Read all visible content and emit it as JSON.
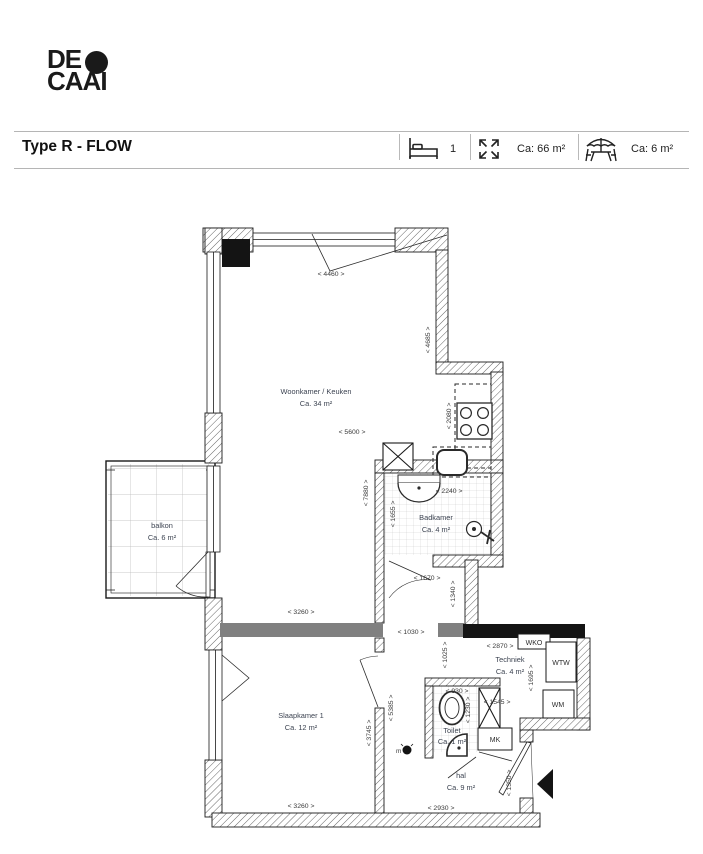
{
  "logo": {
    "line1": "DE",
    "line2": "CAAI"
  },
  "header": {
    "title": "Type R - FLOW",
    "bedroom_count": "1",
    "living_area": "Ca: 66 m²",
    "outdoor_area": "Ca: 6 m²"
  },
  "rooms": {
    "woonkamer": {
      "name": "Woonkamer / Keuken",
      "area": "Ca. 34 m²"
    },
    "balkon": {
      "name": "balkon",
      "area": "Ca. 6 m²"
    },
    "badkamer": {
      "name": "Badkamer",
      "area": "Ca. 4 m²"
    },
    "slaapkamer": {
      "name": "Slaapkamer 1",
      "area": "Ca. 12 m²"
    },
    "techniek": {
      "name": "Techniek",
      "area": "Ca. 4 m²"
    },
    "toilet": {
      "name": "Toilet",
      "area": "Ca. 1 m²"
    },
    "hal": {
      "name": "hal",
      "area": "Ca. 9 m²"
    }
  },
  "closets": {
    "wko": "WKO",
    "wtw": "WTW",
    "wm": "WM",
    "mk": "MK",
    "m_point": "m"
  },
  "dims": {
    "d4460": "< 4460 >",
    "d4685": "< 4685 >",
    "d5600": "< 5600 >",
    "d2080": "< 2080 >",
    "d2240": "< 2240 >",
    "d7880": "< 7880 >",
    "d1655": "< 1655 >",
    "d1670": "< 1670 >",
    "d1340": "< 1340 >",
    "d3260_top": "< 3260 >",
    "d1030": "< 1030 >",
    "d1025": "< 1025 >",
    "d2870": "< 2870 >",
    "d1695": "< 1695 >",
    "d1545": "< 1545 >",
    "d930": "< 930 >",
    "d1230": "< 1230 >",
    "d3745": "< 3745 >",
    "d5385": "< 5385 >",
    "d3260_bottom": "< 3260 >",
    "d2930": "< 2930 >",
    "d1350": "< 1350 >"
  },
  "colors": {
    "wall_gray": "#808080",
    "wall_black": "#141414",
    "accent_text": "#3d4452"
  }
}
